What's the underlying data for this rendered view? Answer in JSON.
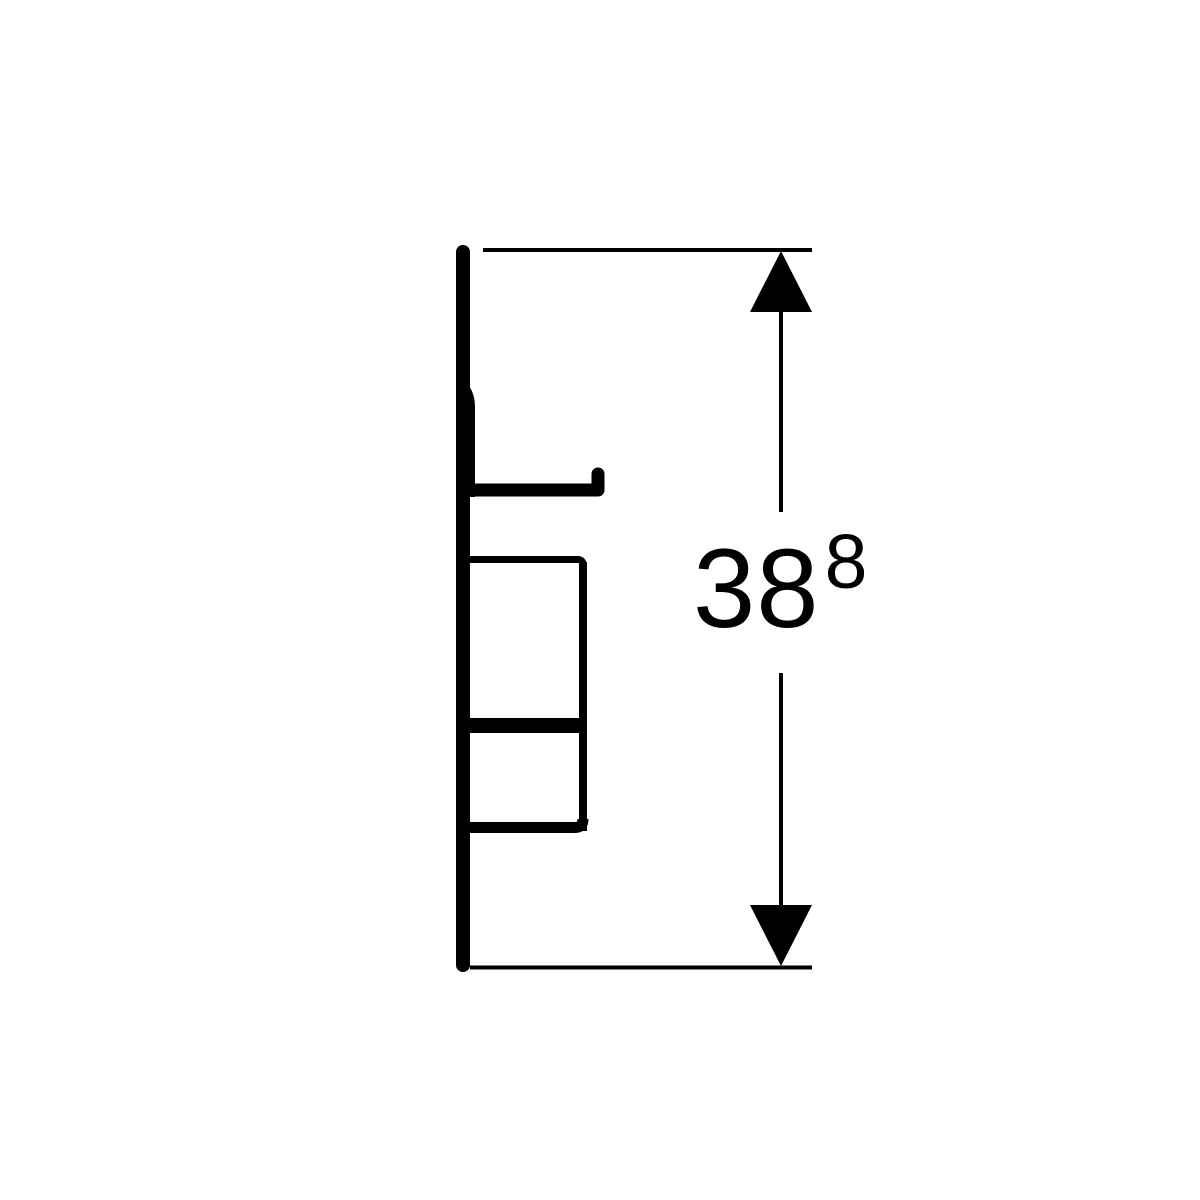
{
  "colors": {
    "line": "#000000",
    "background": "#ffffff"
  },
  "dimension": {
    "value": "38",
    "superscript": "8"
  }
}
